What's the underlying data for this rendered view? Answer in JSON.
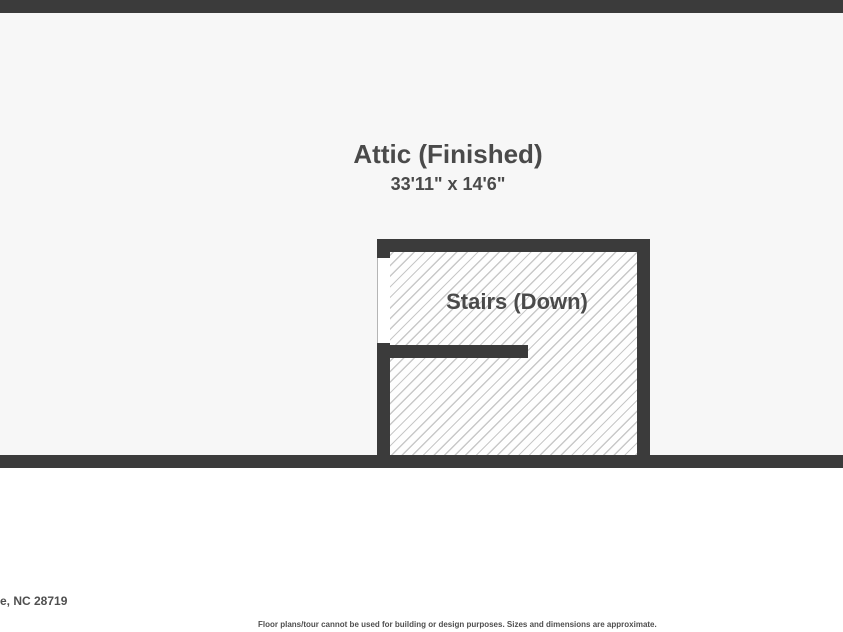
{
  "plan": {
    "room_title": "Attic (Finished)",
    "room_dimensions": "33'11\" x 14'6\"",
    "stairs_label": "Stairs (Down)"
  },
  "footer": {
    "address_partial": "e, NC 28719",
    "disclaimer": "Floor plans/tour cannot be used for building or design purposes. Sizes and dimensions are approximate."
  },
  "colors": {
    "wall": "#3b3b3b",
    "plan_background": "#f7f7f7",
    "room_fill": "#fefefe",
    "hatch_line": "#c8c8c8",
    "label_text": "#4a4a4a",
    "footer_text": "#4f4f4f"
  }
}
